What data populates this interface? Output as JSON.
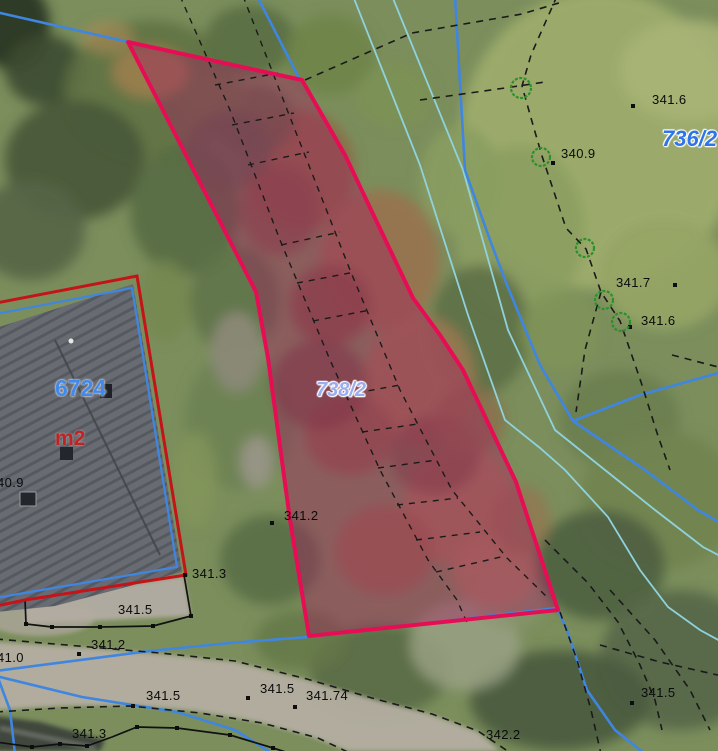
{
  "map": {
    "selected_parcel": {
      "label": "738/2"
    },
    "neighbor_parcel": {
      "label": "736/2"
    },
    "building": {
      "parcel_number": "6724",
      "area_unit": "m2"
    },
    "elevations": [
      {
        "text": "341.6"
      },
      {
        "text": "340.9"
      },
      {
        "text": "341.7"
      },
      {
        "text": "341.6"
      },
      {
        "text": "40.9"
      },
      {
        "text": "341.2"
      },
      {
        "text": "341.3"
      },
      {
        "text": "341.5"
      },
      {
        "text": "341.2"
      },
      {
        "text": "41.0"
      },
      {
        "text": "341.5"
      },
      {
        "text": "341.5"
      },
      {
        "text": "341.74"
      },
      {
        "text": "341.3"
      },
      {
        "text": "342.2"
      },
      {
        "text": "341.5"
      }
    ]
  },
  "colors": {
    "selected_outline": "#e60d55",
    "selected_fill": "rgba(163,28,96,0.42)",
    "cadastral_blue": "#3f86e0",
    "stream_cyan": "#8fd2de",
    "building_outline_red": "#c51317",
    "building_outline_blue": "#3f86e0",
    "boundary_dash_black": "#1a1a1a",
    "neighbor_label_blue": "#2f74e8",
    "selected_label_lavender": "#9badf0",
    "building_number_blue": "#4289ec",
    "area_unit_red": "#c32222",
    "tree_symbol_green": "#2f8f2f"
  }
}
